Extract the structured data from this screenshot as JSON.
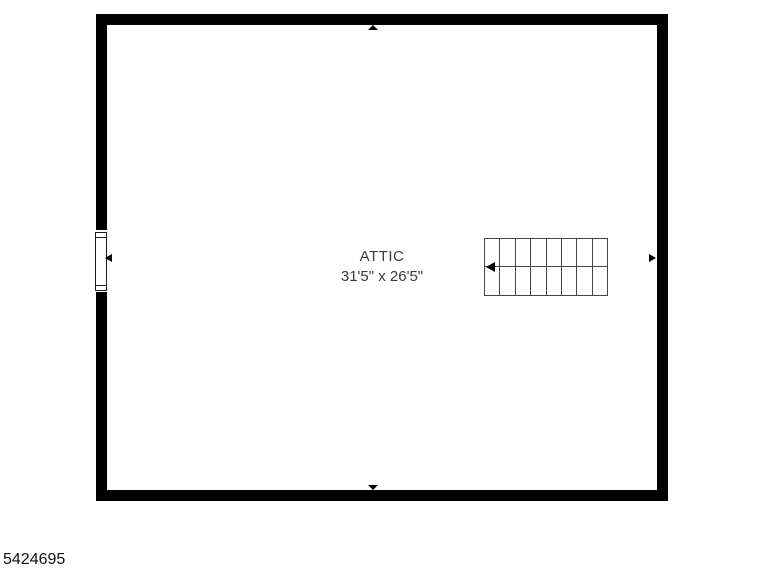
{
  "floorplan": {
    "room": {
      "label": "ATTIC",
      "dimensions": "31'5\" x 26'5\""
    },
    "stairs": {
      "steps": 8,
      "arrow_direction": "left"
    },
    "window": {
      "wall": "left"
    },
    "wall_markers": [
      "top",
      "bottom",
      "left",
      "right"
    ],
    "colors": {
      "wall": "#000000",
      "stair_line": "#454545",
      "text": "#3a3a3a",
      "background": "#ffffff"
    }
  },
  "footer": {
    "listing_id": "5424695"
  }
}
